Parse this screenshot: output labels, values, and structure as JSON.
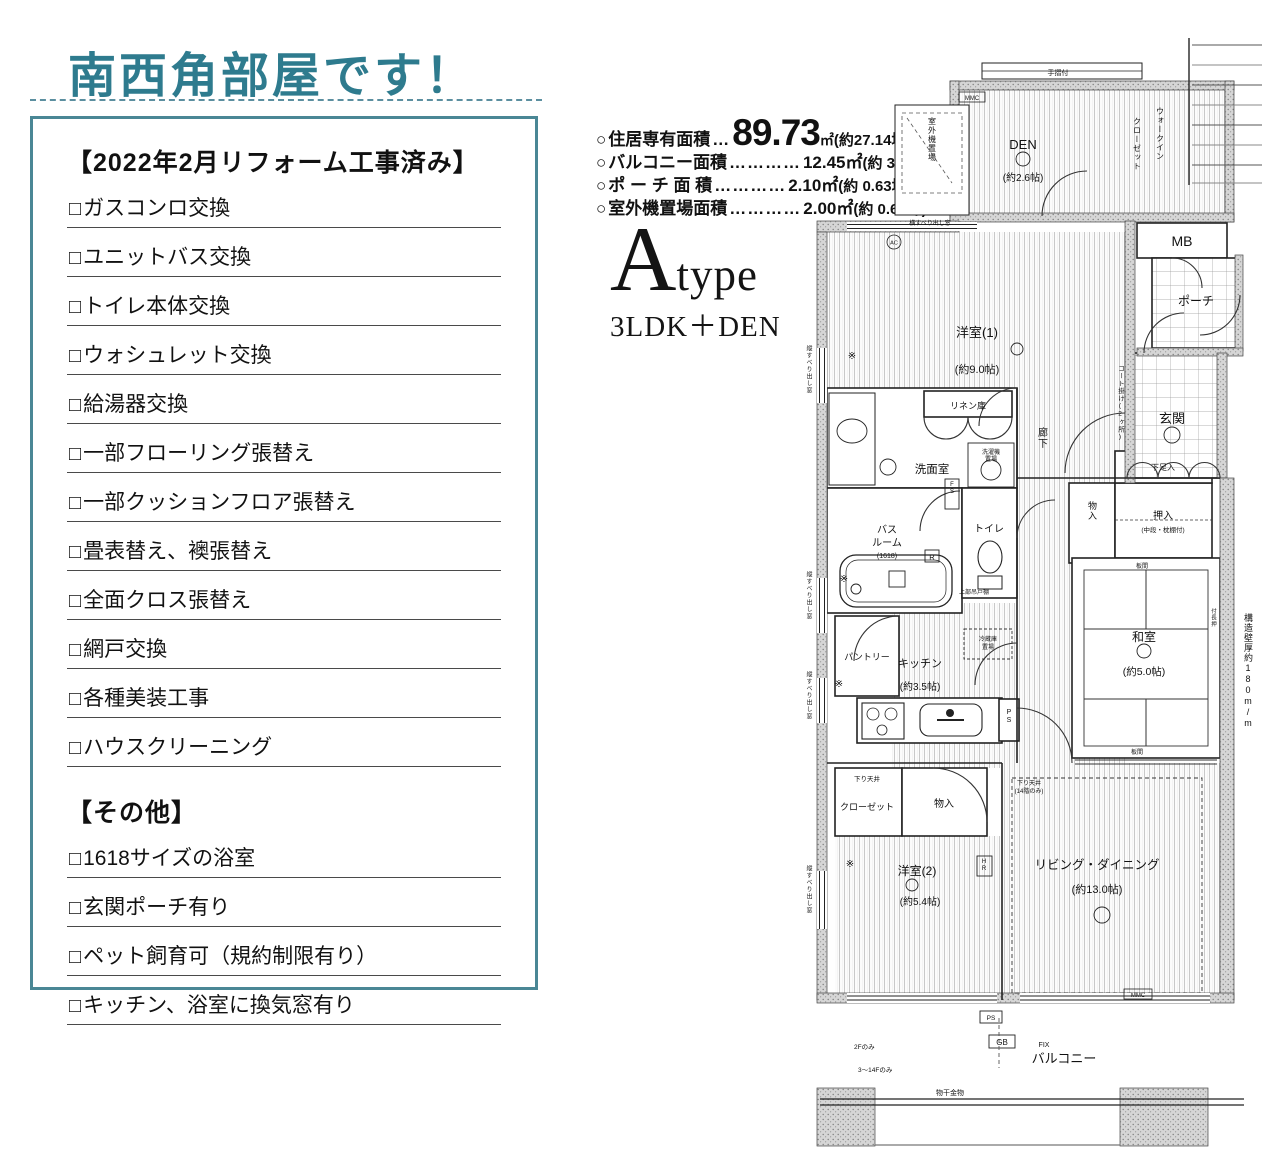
{
  "title": "南西角部屋です！",
  "glyphs": {
    "checkbox": "□",
    "maru": "○"
  },
  "colors": {
    "accent": "#2e7b8e",
    "box_border": "#4a8795"
  },
  "renovation": {
    "heading": "【2022年2月リフォーム工事済み】",
    "items": [
      "ガスコンロ交換",
      "ユニットバス交換",
      "トイレ本体交換",
      "ウォシュレット交換",
      "給湯器交換",
      "一部フローリング張替え",
      "一部クッションフロア張替え",
      "畳表替え、襖張替え",
      "全面クロス張替え",
      "網戸交換",
      "各種美装工事",
      "ハウスクリーニング"
    ]
  },
  "other": {
    "heading": "【その他】",
    "items": [
      "1618サイズの浴室",
      "玄関ポーチ有り",
      "ペット飼育可（規約制限有り）",
      "キッチン、浴室に換気窓有り"
    ]
  },
  "areas": {
    "rows": [
      {
        "label": "住居専有面積",
        "dots": "…",
        "value": "89.73",
        "unit": "㎡",
        "tsubo": "(約27.14坪)"
      },
      {
        "label": "バルコニー面積",
        "dots": "…………",
        "value": "12.45㎡",
        "tsubo": "(約 3.76坪)"
      },
      {
        "label": "ポ ー チ 面 積",
        "dots": "…………",
        "value": "2.10㎡",
        "tsubo": "(約 0.63坪)"
      },
      {
        "label": "室外機置場面積",
        "dots": "…………",
        "value": "2.00㎡",
        "tsubo": "(約 0.60坪)"
      }
    ]
  },
  "type": {
    "letter": "A",
    "word": "type",
    "layout": "3LDK＋DEN"
  },
  "fp": {
    "den_name": "DEN",
    "den_size": "(約2.6帖)",
    "wic_col1": "ウォークイン",
    "wic_col2": "クローゼット",
    "tesuri": "手摺付",
    "outdoor": "室外機置場",
    "yoko_window": "横すべり出し窓",
    "tate_window": "縦すべり出し窓",
    "mmc": "MMC",
    "ac": "AC",
    "r": "R",
    "mb": "MB",
    "porch": "ポーチ",
    "genkan": "玄関",
    "coat": "コート掛け(2ヶ所)",
    "y1_name": "洋室(1)",
    "y1_size": "(約9.0帖)",
    "linen": "リネン庫",
    "senmen": "洗面室",
    "rouka": "廊下",
    "bath1": "バス",
    "bath2": "ルーム",
    "bath_size": "(1618)",
    "fs": "FS",
    "toilet": "トイレ",
    "washer1": "洗濯機",
    "washer2": "置場",
    "tsuridana": "上部吊戸棚",
    "mono": "物入",
    "oshiire": "押入",
    "oshiire_sub": "(中段・枕棚付)",
    "geta": "下足入",
    "washitsu": "和室",
    "washitsu_size": "(約5.0帖)",
    "itama": "板間",
    "nageshi": "付長押",
    "wall_note": "構造壁厚約180m/m",
    "pantry": "パントリー",
    "kitchen": "キッチン",
    "kitchen_size": "(約3.5帖)",
    "fridge1": "冷蔵庫",
    "fridge2": "置場",
    "ps": "PS",
    "sagari": "下り天井",
    "sagari14_1": "下り天井",
    "sagari14_2": "(14階のみ)",
    "closet": "クローゼット",
    "y2_name": "洋室(2)",
    "y2_size": "(約5.4帖)",
    "living": "リビング・ダイニング",
    "living_size": "(約13.0帖)",
    "hr": "HR",
    "gb": "GB",
    "fix": "FIX",
    "balcony": "バルコニー",
    "monohoshi": "物干金物",
    "f2": "2Fのみ",
    "f314": "3〜14Fのみ",
    "kome": "※"
  }
}
